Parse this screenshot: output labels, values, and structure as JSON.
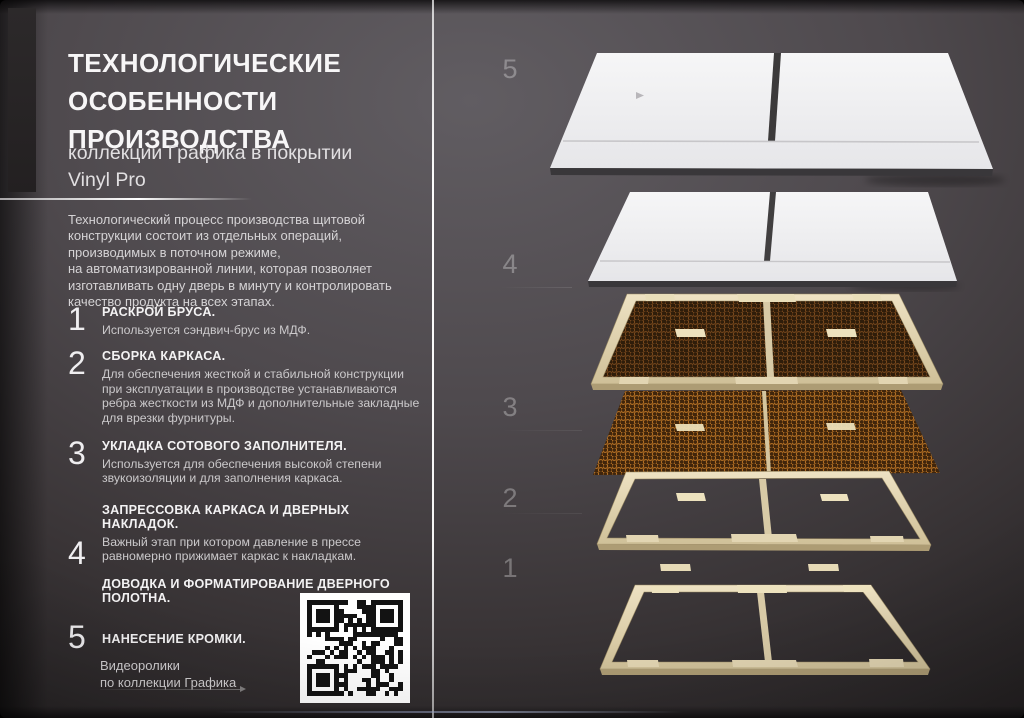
{
  "header": {
    "title": "ТЕХНОЛОГИЧЕСКИЕ ОСОБЕННОСТИ ПРОИЗВОДСТВА",
    "subtitle": "коллекции Графика в покрытии Vinyl Pro"
  },
  "intro": "Технологический процесс производства щитовой\nконструкции состоит из отдельных операций,\nпроизводимых в поточном режиме,\nна автоматизированной линии, которая позволяет\nизготавливать одну дверь в минуту и контролировать\nкачество продукта на всех этапах.",
  "steps": [
    {
      "number": "1",
      "title": "РАСКРОЙ БРУСА.",
      "description": "Используется сэндвич-брус из МДФ."
    },
    {
      "number": "2",
      "title": "СБОРКА КАРКАСА.",
      "description": "Для обеспечения жесткой и стабильной конструкции при эксплуатации в производстве устанавливаются ребра жесткости из МДФ и дополнительные закладные для врезки фурнитуры."
    },
    {
      "number": "3",
      "title": "УКЛАДКА СОТОВОГО ЗАПОЛНИТЕЛЯ.",
      "description": "Используется для обеспечения высокой степени звукоизоляции и для заполнения каркаса."
    },
    {
      "number": "4",
      "title": "ЗАПРЕССОВКА КАРКАСА И ДВЕРНЫХ НАКЛАДОК.",
      "description": "Важный этап при котором давление в прессе равномерно прижимает каркас к накладкам.",
      "title2": "ДОВОДКА И ФОРМАТИРОВАНИЕ ДВЕРНОГО ПОЛОТНА."
    },
    {
      "number": "5",
      "title": "НАНЕСЕНИЕ КРОМКИ."
    }
  ],
  "footer": {
    "video_caption": "Видеоролики\nпо коллекции Графика",
    "qr_icon": "qr-code"
  },
  "diagram": {
    "layer_numbers": [
      "5",
      "4",
      "3",
      "2",
      "1"
    ],
    "layer_names": [
      "finished-door-with-edge-banding",
      "pressed-door-panel",
      "honeycomb-filler-in-frame",
      "honeycomb-filler",
      "door-frame-parts"
    ],
    "colors": {
      "door_panel": "#f2f2f4",
      "frame_wood": "#ddcfae",
      "honeycomb_dark": "#5a3614",
      "honeycomb_light": "#8a5520",
      "background_top": "#5a565b",
      "background_bottom": "#1b1819"
    }
  }
}
